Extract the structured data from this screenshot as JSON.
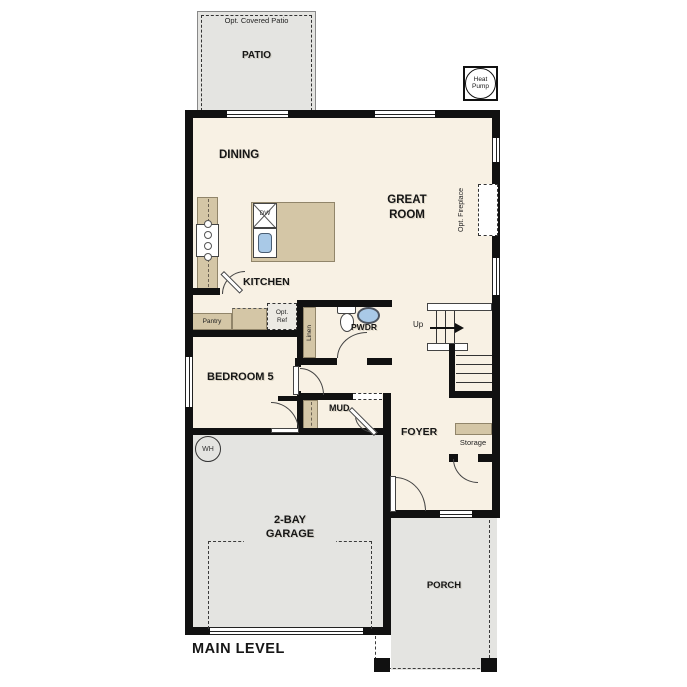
{
  "title": "MAIN LEVEL",
  "colors": {
    "wall": "#111111",
    "floor": "#f8f1e4",
    "outdoor": "#e4e4e1",
    "counter": "#d4c6a6",
    "fixture_blue": "#a9c9e7",
    "line": "#444444"
  },
  "rooms": {
    "patio": {
      "label": "PATIO",
      "note": "Opt. Covered Patio"
    },
    "dining": {
      "label": "DINING"
    },
    "great_room": {
      "line1": "GREAT",
      "line2": "ROOM"
    },
    "fireplace": {
      "note": "Opt. Fireplace"
    },
    "kitchen": {
      "label": "KITCHEN"
    },
    "pantry": {
      "label": "Pantry"
    },
    "opt_ref": {
      "line1": "Opt.",
      "line2": "Ref"
    },
    "linen": {
      "label": "Linen"
    },
    "powder": {
      "label": "PWDR"
    },
    "bedroom5": {
      "label": "BEDROOM 5"
    },
    "mud": {
      "label": "MUD"
    },
    "foyer": {
      "label": "FOYER"
    },
    "storage": {
      "label": "Storage"
    },
    "stairs": {
      "up": "Up"
    },
    "garage": {
      "line1": "2-BAY",
      "line2": "GARAGE"
    },
    "porch": {
      "label": "PORCH"
    }
  },
  "equipment": {
    "heat_pump": {
      "line1": "Heat",
      "line2": "Pump"
    },
    "water_heater": {
      "label": "WH"
    },
    "dishwasher": {
      "label": "DW"
    }
  }
}
